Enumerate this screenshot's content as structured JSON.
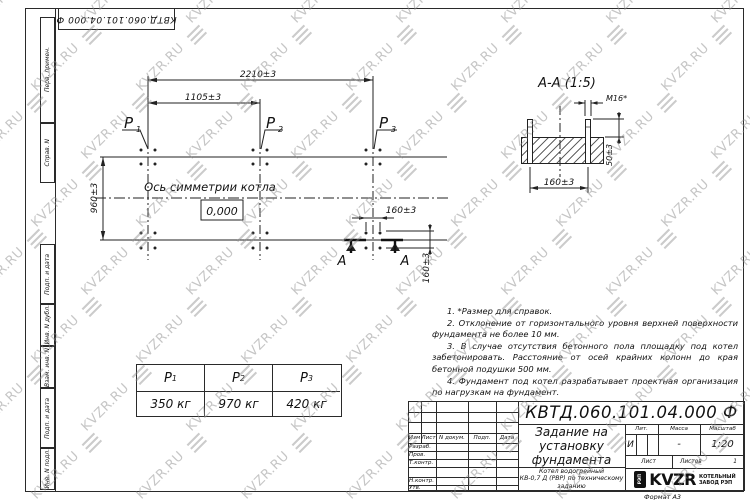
{
  "watermark": {
    "text": "KVZR.RU"
  },
  "corner_stamp": {
    "text": "КВТД.060.101.04.000  Ф"
  },
  "side_labels": {
    "top": [
      "Перв. примен.",
      "Справ. N"
    ],
    "bottom": [
      "Подп. и дата",
      "Инв. N дубл.",
      "Взам. инв. N",
      "Подп. и дата",
      "Инв. N подл."
    ]
  },
  "plan": {
    "dim_width_total": "2210±3",
    "dim_width_half": "1105±3",
    "dim_height": "960±3",
    "dim_bolt_x": "160±3",
    "dim_bolt_y": "160±3",
    "axis_label": "Ось симметрии котла",
    "level": "0,000",
    "loads": [
      {
        "name": "P",
        "sub": "1"
      },
      {
        "name": "P",
        "sub": "2"
      },
      {
        "name": "P",
        "sub": "3"
      }
    ],
    "section_letter": "А"
  },
  "section_view": {
    "title": "А-А (1:5)",
    "thread": "М16*",
    "dim_height": "50±3",
    "dim_width": "160±3"
  },
  "notes": [
    "1. *Размер для справок.",
    "2. Отклонение от горизонтального уровня верхней поверхности фундамента не более 10 мм.",
    "3. В случае отсутствия бетонного пола площадку под котел забетонировать. Расстояние от осей крайних колонн до края бетонной подушки 500 мм.",
    "4. Фундамент под котел разрабатывает проектная организация по нагрузкам на фундамент."
  ],
  "load_table": {
    "headers": [
      {
        "name": "P",
        "sub": "1"
      },
      {
        "name": "P",
        "sub": "2"
      },
      {
        "name": "P",
        "sub": "3"
      }
    ],
    "values": [
      "350 кг",
      "970 кг",
      "420 кг"
    ]
  },
  "title_block": {
    "doc_number": "КВТД.060.101.04.000  Ф",
    "title": [
      "Задание на",
      "установку",
      "фундамента"
    ],
    "header_cols": [
      "Изм",
      "Лист",
      "N докум.",
      "Подп.",
      "Дата"
    ],
    "role_rows": [
      "Разраб.",
      "Пров.",
      "Т.контр.",
      "Н.контр.",
      "Утв."
    ],
    "lit_label": "Лит.",
    "lit_value": "И",
    "mass_label": "Масса",
    "mass_value": "-",
    "scale_label": "Масштаб",
    "scale_value": "1:20",
    "sheet_label": "Лист",
    "sheets_label": "Листов",
    "sheets_value": "1",
    "product": [
      "Котел водогрейный",
      "КВ-0,7 Д (РВР) по техническому",
      "заданию"
    ],
    "logo_text": "KVZR",
    "logo_emblem": "РЭП",
    "logo_sub": [
      "КОТЕЛЬНЫЙ",
      "ЗАВОД РЭП"
    ],
    "format_note": "Формат А3"
  }
}
